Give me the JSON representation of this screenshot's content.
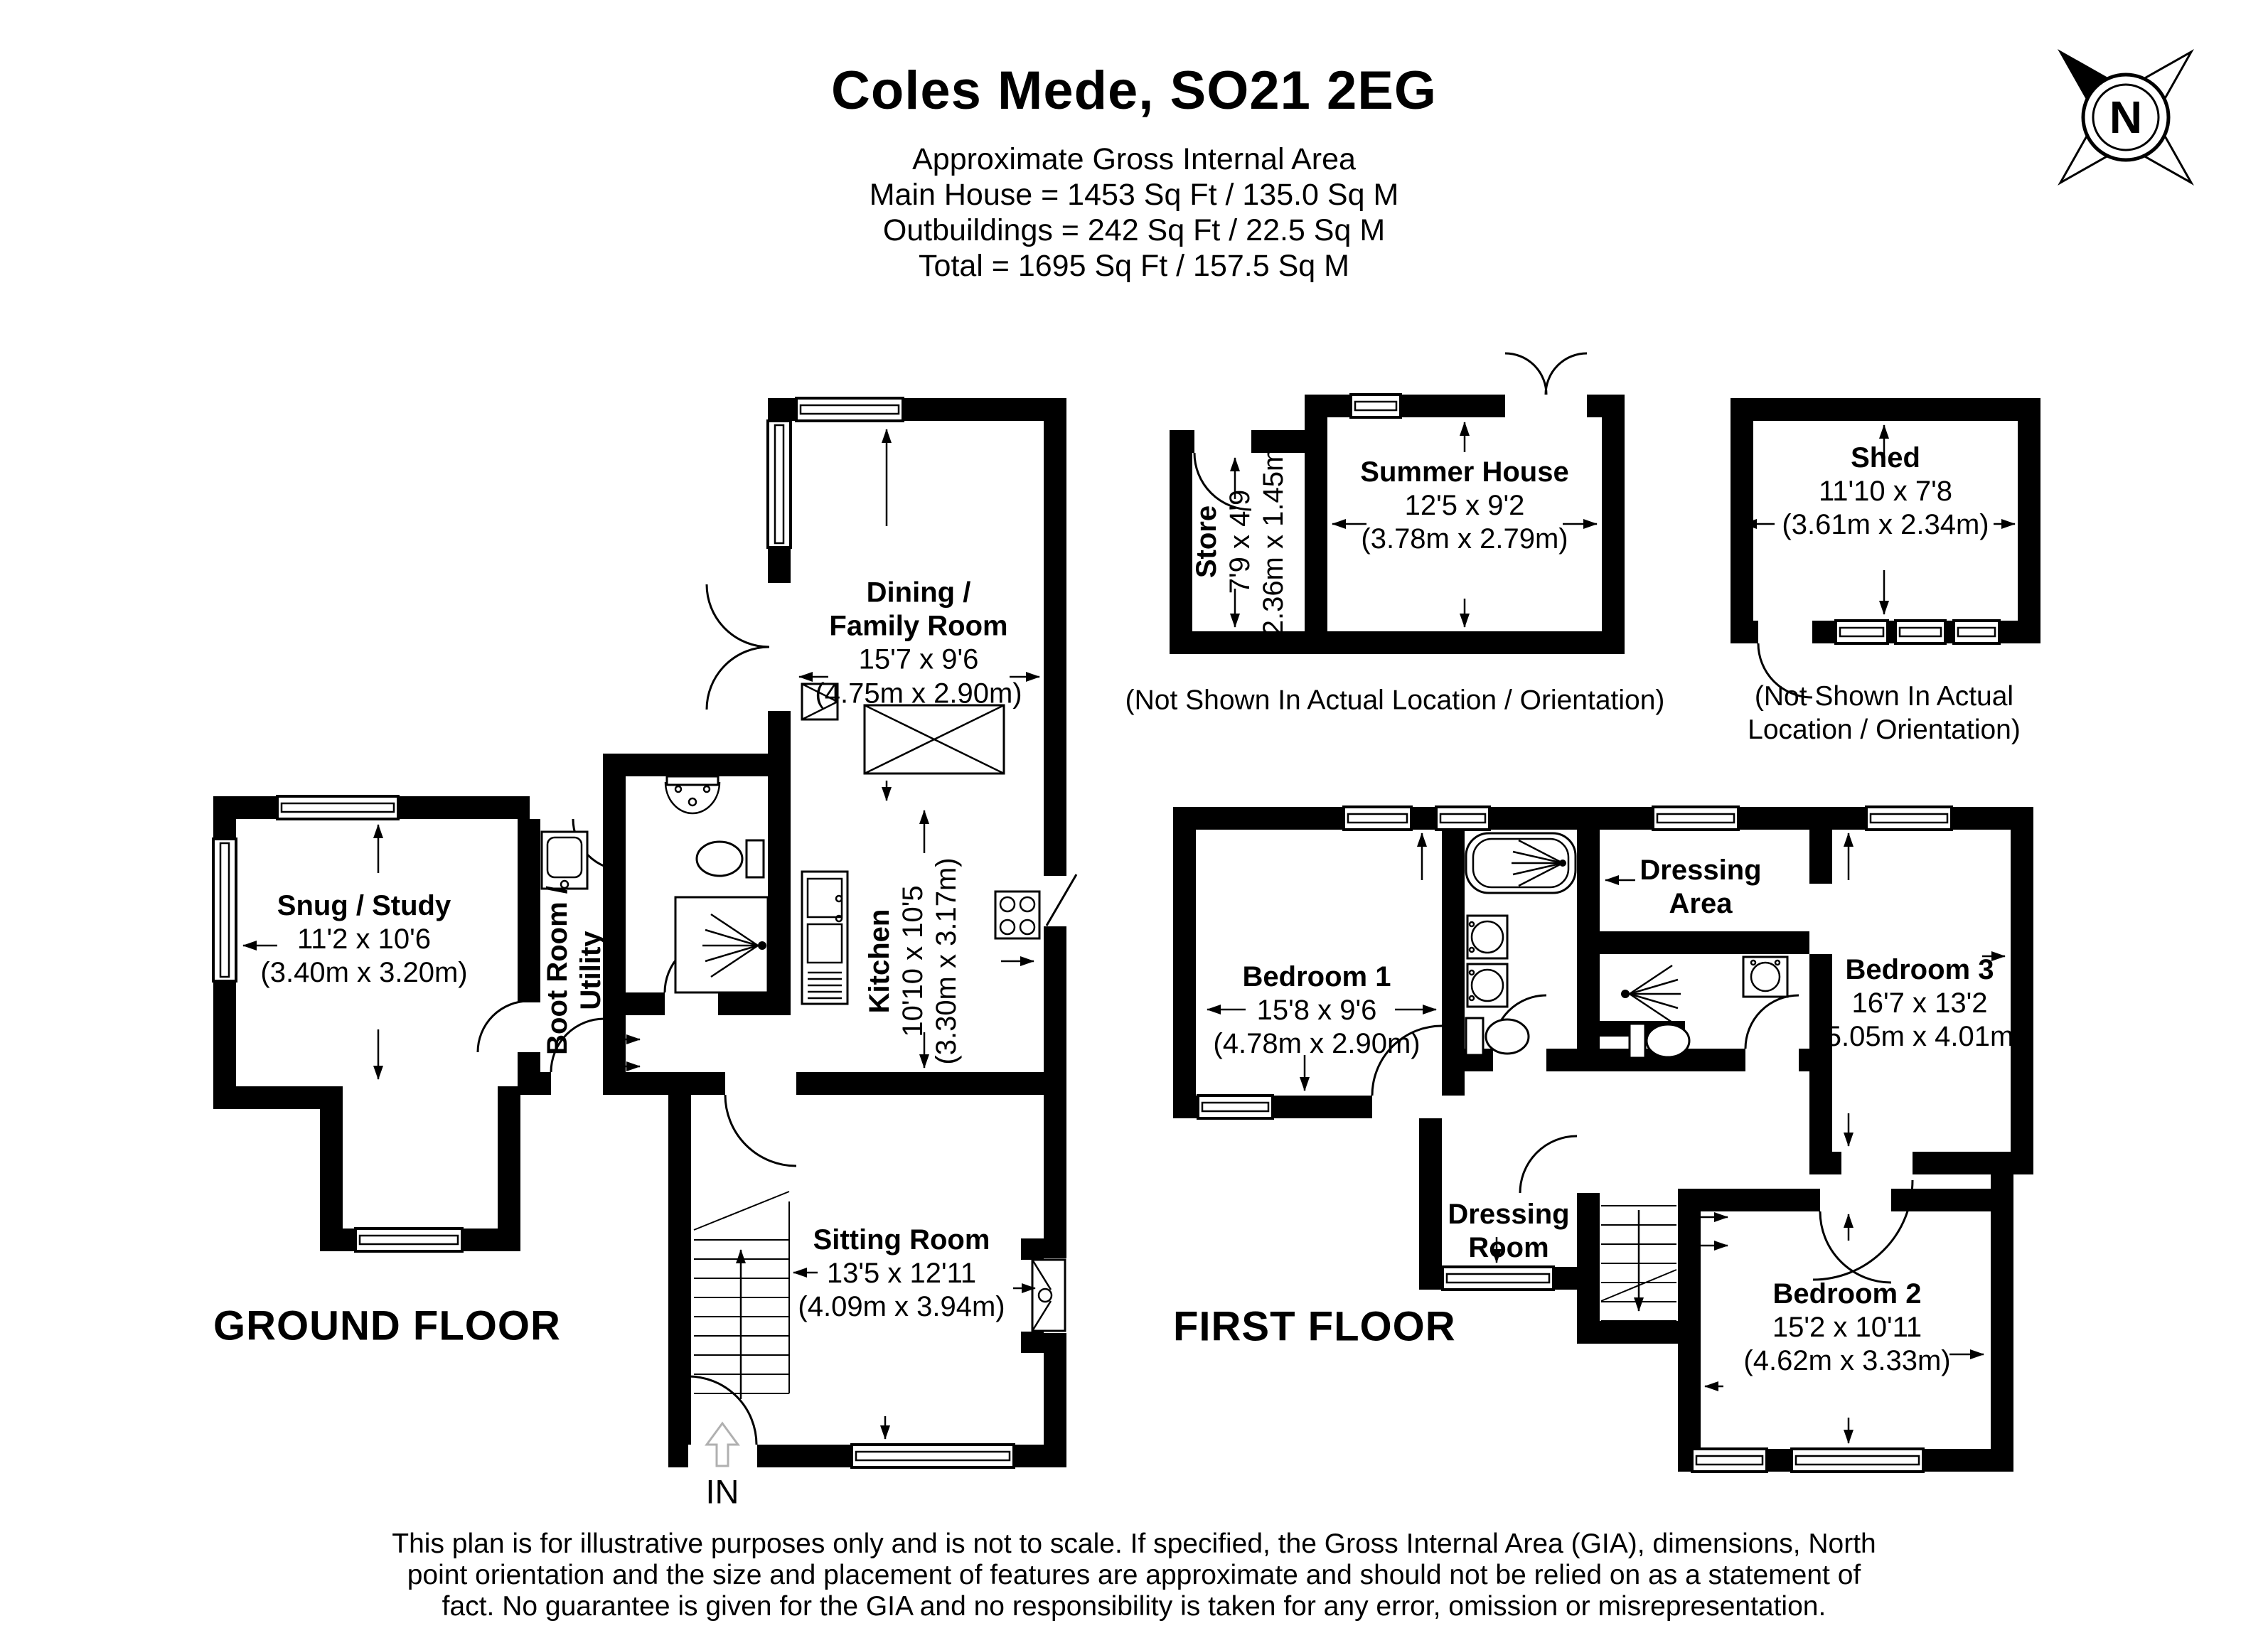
{
  "header": {
    "title": "Coles Mede, SO21 2EG",
    "subtitle": [
      "Approximate Gross Internal Area",
      "Main House = 1453 Sq Ft / 135.0 Sq M",
      "Outbuildings = 242 Sq Ft / 22.5 Sq M",
      "Total = 1695 Sq Ft / 157.5 Sq M"
    ]
  },
  "compass": {
    "north_label": "N"
  },
  "ground_floor": {
    "label": "GROUND FLOOR",
    "entrance_label": "IN",
    "rooms": {
      "dining": {
        "name_line1": "Dining /",
        "name_line2": "Family Room",
        "size_imperial": "15'7 x 9'6",
        "size_metric": "(4.75m x 2.90m)"
      },
      "snug": {
        "name": "Snug / Study",
        "size_imperial": "11'2 x 10'6",
        "size_metric": "(3.40m x 3.20m)"
      },
      "boot_room": {
        "name_line1": "Boot Room /",
        "name_line2": "Utility"
      },
      "kitchen": {
        "name": "Kitchen",
        "size_imperial": "10'10 x 10'5",
        "size_metric": "(3.30m x 3.17m)"
      },
      "sitting": {
        "name": "Sitting Room",
        "size_imperial": "13'5 x 12'11",
        "size_metric": "(4.09m x 3.94m)"
      }
    }
  },
  "first_floor": {
    "label": "FIRST FLOOR",
    "rooms": {
      "bedroom1": {
        "name": "Bedroom 1",
        "size_imperial": "15'8 x 9'6",
        "size_metric": "(4.78m x 2.90m)"
      },
      "dressing_area": {
        "name_line1": "Dressing",
        "name_line2": "Area"
      },
      "bedroom3": {
        "name": "Bedroom 3",
        "size_imperial": "16'7 x 13'2",
        "size_metric": "(5.05m x 4.01m)"
      },
      "dressing_room": {
        "name_line1": "Dressing",
        "name_line2": "Room"
      },
      "bedroom2": {
        "name": "Bedroom 2",
        "size_imperial": "15'2 x 10'11",
        "size_metric": "(4.62m x 3.33m)"
      }
    }
  },
  "outbuildings": {
    "store": {
      "name": "Store",
      "size_imperial": "7'9 x 4'9",
      "size_metric": "(2.36m x 1.45m)"
    },
    "summer_house": {
      "name": "Summer House",
      "size_imperial": "12'5 x 9'2",
      "size_metric": "(3.78m x 2.79m)",
      "caption": "(Not Shown In Actual Location / Orientation)"
    },
    "shed": {
      "name": "Shed",
      "size_imperial": "11'10 x 7'8",
      "size_metric": "(3.61m x 2.34m)",
      "caption_line1": "(Not Shown In Actual",
      "caption_line2": "Location / Orientation)"
    }
  },
  "footer": {
    "line1": "This plan is for illustrative purposes only and is not to scale. If specified, the Gross Internal Area (GIA), dimensions, North",
    "line2": "point orientation and the size and placement of features are approximate and should not be relied on as a statement of",
    "line3": "fact. No guarantee is given for the GIA and no responsibility is taken for any error, omission or misrepresentation."
  }
}
